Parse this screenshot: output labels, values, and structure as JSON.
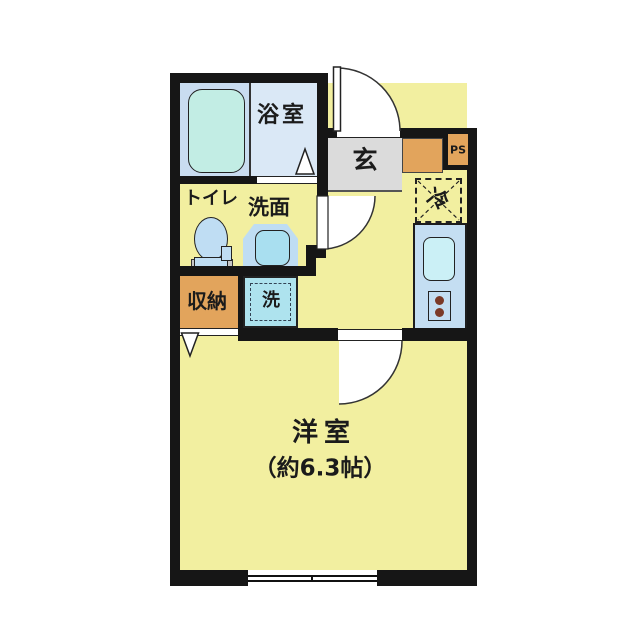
{
  "title": "apartment-floor-plan",
  "rooms": {
    "bathroom": {
      "label": "浴室"
    },
    "entrance": {
      "label": "玄"
    },
    "pipe_space": {
      "label": "PS"
    },
    "refrigerator": {
      "label": "冷"
    },
    "toilet": {
      "label": "トイレ"
    },
    "washstand": {
      "label": "洗面"
    },
    "storage": {
      "label": "収納"
    },
    "laundry": {
      "label": "洗"
    },
    "main_room": {
      "label": "洋室",
      "size": "（約6.3帖）"
    }
  },
  "colors": {
    "page_bg": "#ffffff",
    "wall": "#161616",
    "text": "#1b1b1b",
    "room_yellow": "#F2EFA0",
    "bath_alcove": "#C9DCF0",
    "bath_floor": "#DAE8F6",
    "bathtub": "#C2EDE4",
    "fixture_blue": "#BFDDF3",
    "basin_inner": "#A9DFF0",
    "laundry_pan": "#AEE3EE",
    "kitchen_counter": "#C4DEF2",
    "sink": "#CBF0F6",
    "burner": "#7B3A28",
    "storage_orange": "#E2A45C",
    "entry_gray": "#DBDBDB"
  }
}
